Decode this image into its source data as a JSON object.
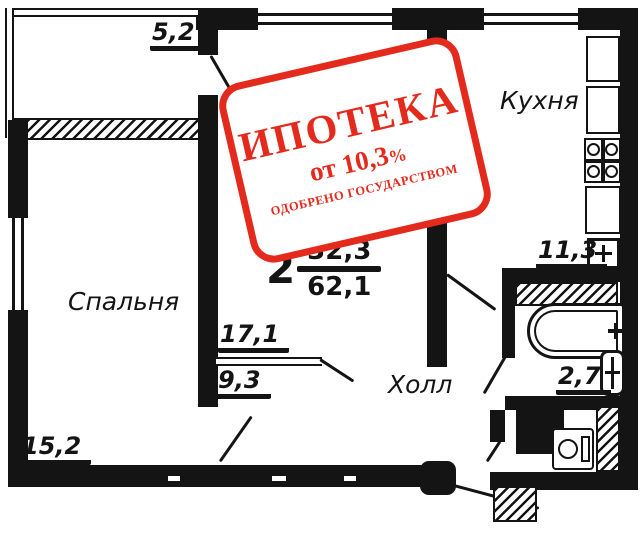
{
  "plan": {
    "designation": {
      "rooms_count": "2",
      "living_area": "32,3",
      "total_area": "62,1"
    },
    "rooms": {
      "balcony": {
        "area": "5,2"
      },
      "bedroom": {
        "name": "Спальня",
        "area": "15,2"
      },
      "living": {
        "name": "Гостиная",
        "area": "17,1"
      },
      "kitchen": {
        "name": "Кухня",
        "area": "11,3"
      },
      "hall": {
        "name": "Холл",
        "area": "9,3"
      },
      "bathroom": {
        "area": "2,7"
      }
    }
  },
  "stamp": {
    "title": "ИПОТЕКА",
    "rate_prefix": "от",
    "rate_value": "10,3",
    "rate_percent": "%",
    "subtitle": "ОДОБРЕНО ГОСУДАРСТВОМ",
    "color": "#e32a1d"
  },
  "colors": {
    "wall": "#141414",
    "background": "#ffffff"
  }
}
